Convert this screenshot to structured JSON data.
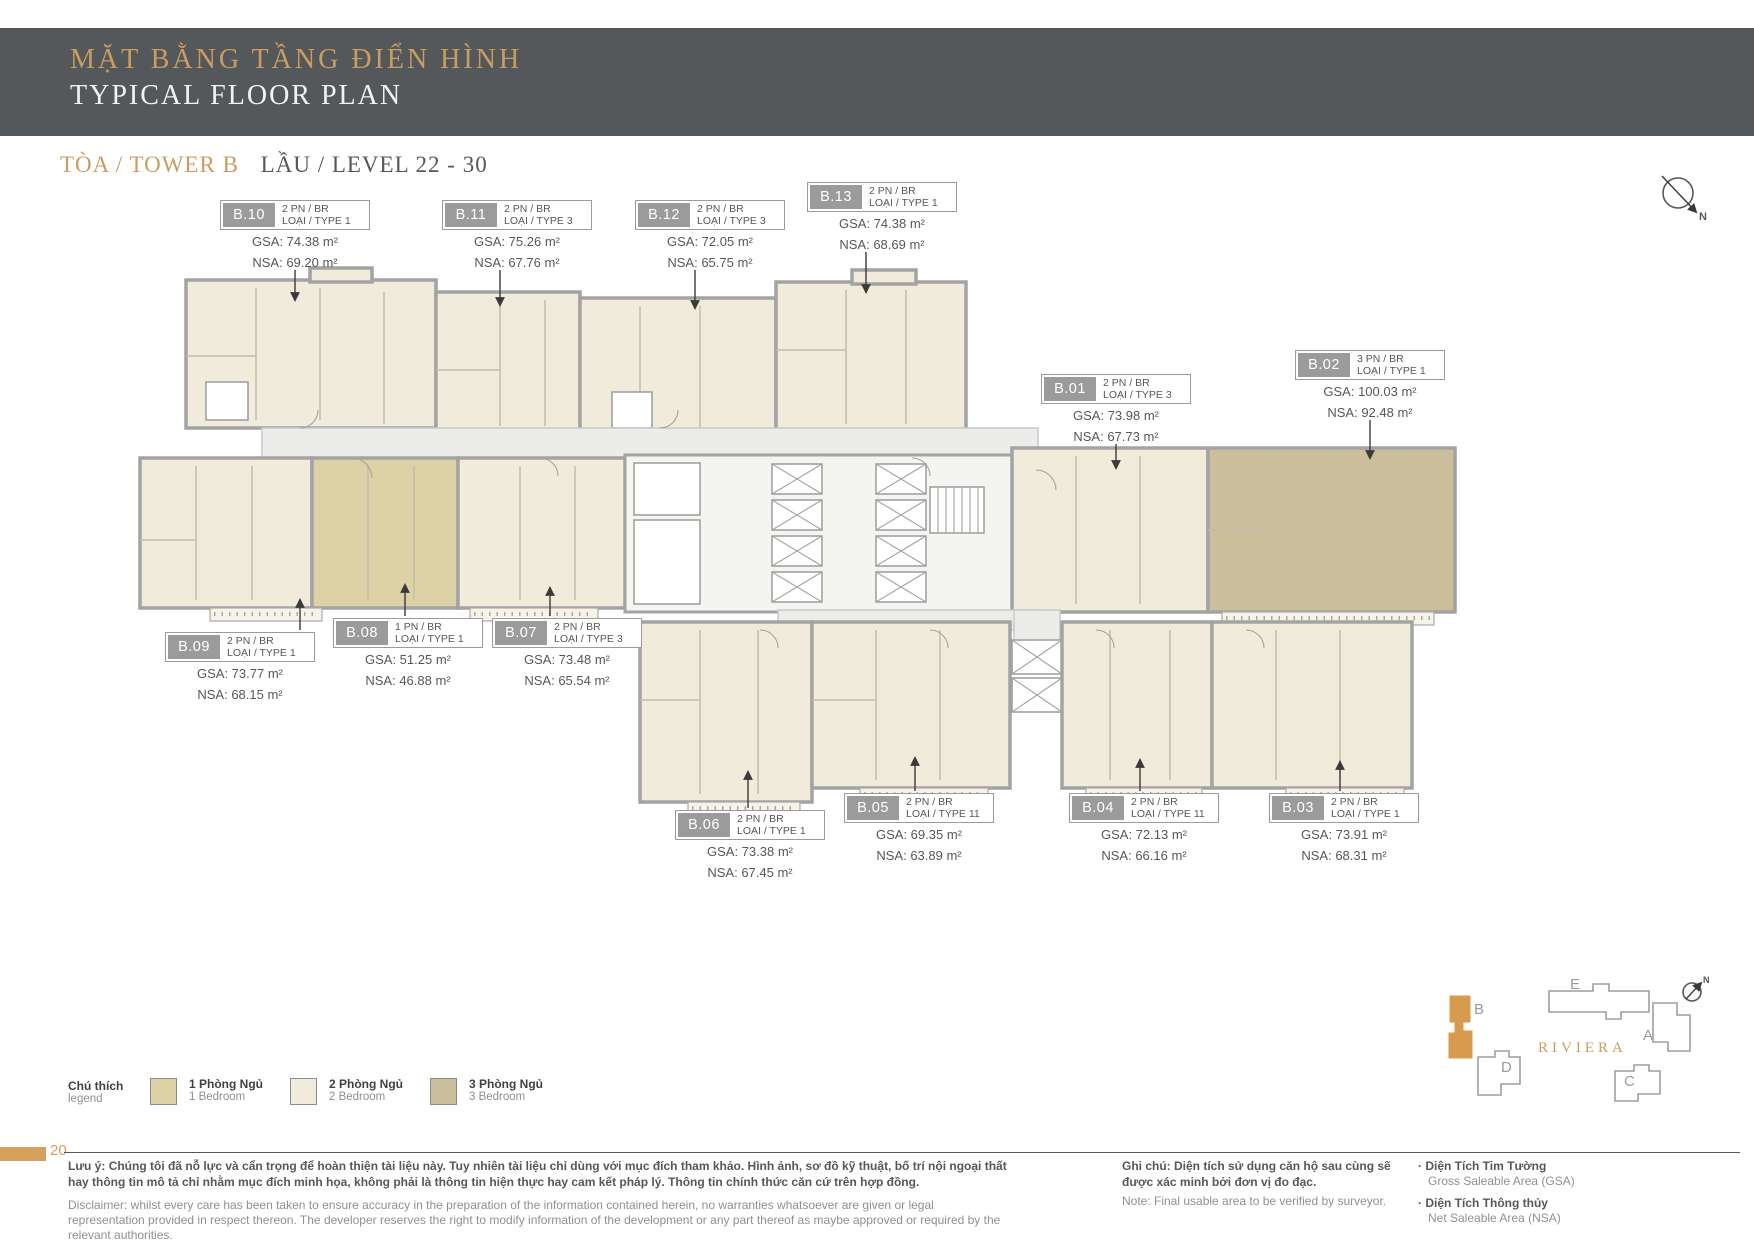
{
  "header": {
    "title_vn": "MẶT BẰNG TẦNG ĐIỂN HÌNH",
    "title_en": "TYPICAL FLOOR PLAN"
  },
  "subtitle": {
    "tower": "TÒA / TOWER B",
    "level": "LẦU / LEVEL 22 - 30"
  },
  "compass": {
    "label": "N"
  },
  "units": [
    {
      "code": "B.10",
      "bedrooms": "2 PN / BR",
      "type": "LOẠI / TYPE 1",
      "gsa": "GSA: 74.38 m²",
      "nsa": "NSA: 69.20 m²"
    },
    {
      "code": "B.11",
      "bedrooms": "2 PN / BR",
      "type": "LOẠI / TYPE 3",
      "gsa": "GSA: 75.26 m²",
      "nsa": "NSA: 67.76 m²"
    },
    {
      "code": "B.12",
      "bedrooms": "2 PN / BR",
      "type": "LOẠI / TYPE 3",
      "gsa": "GSA: 72.05 m²",
      "nsa": "NSA: 65.75 m²"
    },
    {
      "code": "B.13",
      "bedrooms": "2 PN / BR",
      "type": "LOẠI / TYPE 1",
      "gsa": "GSA: 74.38 m²",
      "nsa": "NSA: 68.69 m²"
    },
    {
      "code": "B.01",
      "bedrooms": "2 PN / BR",
      "type": "LOẠI / TYPE 3",
      "gsa": "GSA: 73.98 m²",
      "nsa": "NSA: 67.73 m²"
    },
    {
      "code": "B.02",
      "bedrooms": "3 PN / BR",
      "type": "LOẠI / TYPE 1",
      "gsa": "GSA: 100.03 m²",
      "nsa": "NSA: 92.48 m²"
    },
    {
      "code": "B.09",
      "bedrooms": "2 PN / BR",
      "type": "LOẠI / TYPE 1",
      "gsa": "GSA: 73.77 m²",
      "nsa": "NSA: 68.15 m²"
    },
    {
      "code": "B.08",
      "bedrooms": "1 PN / BR",
      "type": "LOẠI / TYPE 1",
      "gsa": "GSA: 51.25 m²",
      "nsa": "NSA: 46.88 m²"
    },
    {
      "code": "B.07",
      "bedrooms": "2 PN / BR",
      "type": "LOẠI / TYPE 3",
      "gsa": "GSA: 73.48 m²",
      "nsa": "NSA: 65.54 m²"
    },
    {
      "code": "B.06",
      "bedrooms": "2 PN / BR",
      "type": "LOẠI / TYPE 1",
      "gsa": "GSA: 73.38 m²",
      "nsa": "NSA: 67.45 m²"
    },
    {
      "code": "B.05",
      "bedrooms": "2 PN / BR",
      "type": "LOẠI / TYPE 11",
      "gsa": "GSA: 69.35 m²",
      "nsa": "NSA: 63.89 m²"
    },
    {
      "code": "B.04",
      "bedrooms": "2 PN / BR",
      "type": "LOẠI / TYPE 11",
      "gsa": "GSA: 72.13 m²",
      "nsa": "NSA: 66.16 m²"
    },
    {
      "code": "B.03",
      "bedrooms": "2 PN / BR",
      "type": "LOẠI / TYPE 1",
      "gsa": "GSA: 73.91 m²",
      "nsa": "NSA: 68.31 m²"
    }
  ],
  "legend": {
    "title_vn": "Chú thích",
    "title_en": "legend",
    "items": [
      {
        "label_vn": "1 Phòng Ngủ",
        "label_en": "1 Bedroom",
        "color": "#ddd2a6"
      },
      {
        "label_vn": "2 Phòng Ngủ",
        "label_en": "2 Bedroom",
        "color": "#f1ebdb"
      },
      {
        "label_vn": "3 Phòng Ngủ",
        "label_en": "3 Bedroom",
        "color": "#cabf9a"
      }
    ]
  },
  "sitemap": {
    "project": "RIVIERA",
    "highlight": "B",
    "highlight_color": "#d89b4e",
    "compass_label": "N",
    "buildings": [
      {
        "label": "B"
      },
      {
        "label": "E"
      },
      {
        "label": "A"
      },
      {
        "label": "D"
      },
      {
        "label": "C"
      }
    ]
  },
  "footer": {
    "page": "20",
    "disclaimer_vn": "Lưu ý: Chúng tôi đã nỗ lực và cẩn trọng để hoàn thiện tài liệu này. Tuy nhiên tài liệu chỉ dùng với mục đích tham khảo. Hình ảnh, sơ đồ kỹ thuật, bố trí nội ngoại thất hay thông tin mô tả chỉ nhằm mục đích minh họa, không phải là thông tin hiện thực hay cam kết pháp lý. Thông tin chính thức căn cứ trên hợp đồng.",
    "disclaimer_en": "Disclaimer: whilst every care has been taken to ensure accuracy in the preparation of the information contained herein, no warranties whatsoever are given or legal representation provided in respect thereon. The developer reserves the right to modify information of the development or any part thereof as maybe approved or required by the relevant authorities.",
    "note_vn": "Ghi chú: Diện tích sử dụng căn hộ sau cùng sẽ được xác minh bởi đơn vị đo đạc.",
    "note_en": "Note: Final usable area to be verified by surveyor.",
    "gsa_vn": "· Diện Tích Tim Tường",
    "gsa_en": "Gross Saleable Area (GSA)",
    "nsa_vn": "· Diện Tích Thông thủy",
    "nsa_en": "Net Saleable Area (NSA)"
  },
  "colors": {
    "accent_gold": "#c99c60",
    "header_band": "#55585a",
    "label_gray": "#9b9b9b",
    "page_tab_orange": "#d6a05c"
  }
}
